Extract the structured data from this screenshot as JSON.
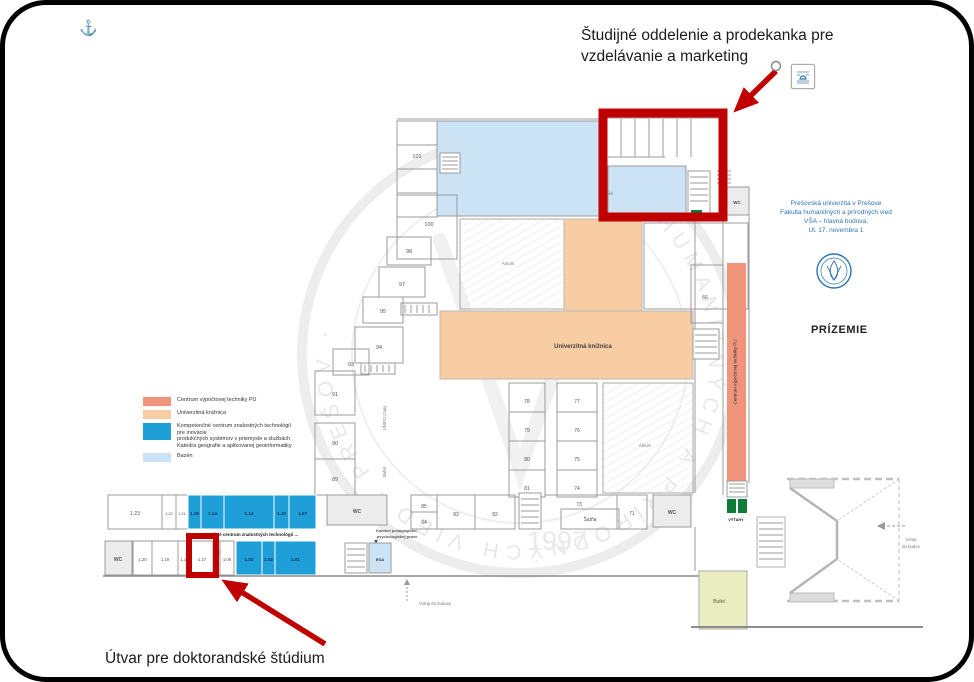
{
  "callouts": {
    "top_line1": "Študijné oddelenie a prodekanka pre",
    "top_line2": "vzdelávanie a marketing",
    "bottom": "Útvar pre doktorandské štúdium"
  },
  "info_block": {
    "line1": "Prešovská univerzita v Prešove",
    "line2": "Fakulta humanitných a prírodných vied",
    "line3": "VŠA – hlavná budova,",
    "line4": "Ul. 17. novembra 1"
  },
  "floor_label": "PRÍZEMIE",
  "anchor_glyph": "⚓",
  "legend": {
    "items": [
      {
        "label": "Centrum výpočtovej techniky PU"
      },
      {
        "label": "Univerzitná knižnica"
      },
      {
        "label_l1": "Kompetenčné centrum znalostných technológií pre inovácie",
        "label_l2": "produkčných systémov v priemysle a službách",
        "label_l3": "Katedra geografie a aplikovanej geoinformatiky"
      },
      {
        "label": "Bazén"
      }
    ]
  },
  "colors": {
    "annotation_red": "#C00000",
    "pool": "#CBE3F5",
    "library": "#F8CDA4",
    "computing": "#F0957C",
    "competence": "#1F9FD8",
    "buffet": "#E9EDC0",
    "elevator_green": "#0E7B3A",
    "ui_blue": "#2E74B5"
  },
  "plan": {
    "labels": {
      "library": "Univerzitná knižnica",
      "computing": "Centrum výpočtovej techniky PU",
      "competence_caption": "Kompetenčné centrum znalostných technológií ...",
      "atrium": "Átrium",
      "pool": "Bazén",
      "cloakroom": "Šatňa",
      "buffet": "Bufet",
      "elevators": "VÝŤAHY",
      "wc": "WC",
      "entry_main": "Vstup do budovy",
      "entry_side_l1": "Vstup",
      "entry_side_l2": "do budov",
      "copy_center": "UNIPO Copy",
      "buffet_corridor": "Bufet",
      "kabinet_line1": "Kabinet pedagogicko-",
      "kabinet_line2": "psychologickej praxe",
      "esa": "ESA",
      "year": "1997",
      "seal": "FAKULTA HUMANITNÝCH A PRÍRODNÝCH VIED · PREŠOV ·"
    },
    "rooms": [
      "101",
      "100",
      "98",
      "97",
      "95",
      "94",
      "93",
      "91",
      "90",
      "89",
      "85",
      "84",
      "83",
      "82",
      "78",
      "79",
      "80",
      "81",
      "77",
      "76",
      "75",
      "74",
      "73",
      "71",
      "66"
    ],
    "rooms_row1": [
      "1.23",
      "1.22",
      "1.21",
      "1.15",
      "1.14",
      "1.13",
      "1.10",
      "1.07"
    ],
    "rooms_row2": [
      "1.20",
      "1.19",
      "1.18",
      "1.17",
      "1.16",
      "1.06",
      "1.03",
      "1.02",
      "1.01"
    ]
  }
}
